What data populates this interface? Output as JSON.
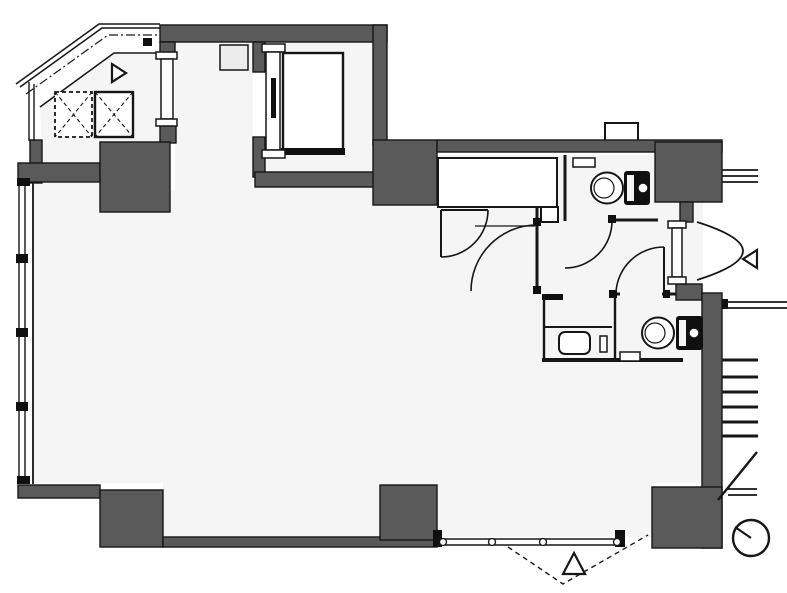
{
  "document": {
    "type": "architectural-floor-plan",
    "description": "Monochrome building floor plan: open main room, elevator bank at top-left, elevator/stair shaft top-center, two WC rooms and sink at east side, exterior stair at south-east, window walls on west and south",
    "text_labels": []
  },
  "canvas": {
    "width": 787,
    "height": 593
  },
  "colors": {
    "background": "#ffffff",
    "wall": "#5a5a5a",
    "floor": "#f5f5f5",
    "line": "#161616",
    "fixture": "#101010",
    "shaft_box": "#ececec"
  },
  "elements": {
    "elevators": {
      "count": 2,
      "symbol": "box-with-X",
      "styles": [
        "dashed-outline",
        "solid-outline"
      ]
    },
    "elevator_lobby_duct": {
      "shape": "small-square"
    },
    "service_shaft_car": {
      "shape": "rectangle-with-door-track"
    },
    "toilets": {
      "count": 2,
      "parts": [
        "oval-bowl",
        "dark-tank",
        "flush-button-circle"
      ]
    },
    "sink": {
      "count": 1,
      "shape": "rounded-square"
    },
    "entry_markers": {
      "count": 3,
      "shape": "open-triangle",
      "directions": [
        "right",
        "left",
        "up"
      ]
    },
    "door_swings": {
      "count": 6,
      "symbol": "quarter-arc"
    },
    "folding_door_swing": {
      "style": "dashed-V",
      "location": "south-glass-wall"
    },
    "stairs": {
      "step_lines": 6,
      "location": "east-exterior",
      "extras": [
        "diagonal-break-line",
        "double-railing-lines"
      ]
    },
    "windows": {
      "west_mullions": 3,
      "south_pivot_dots": 4,
      "corner": "chamfered-north-west"
    },
    "survey_marker": {
      "shape": "circle-with-radius-line",
      "location": "south-east"
    }
  }
}
